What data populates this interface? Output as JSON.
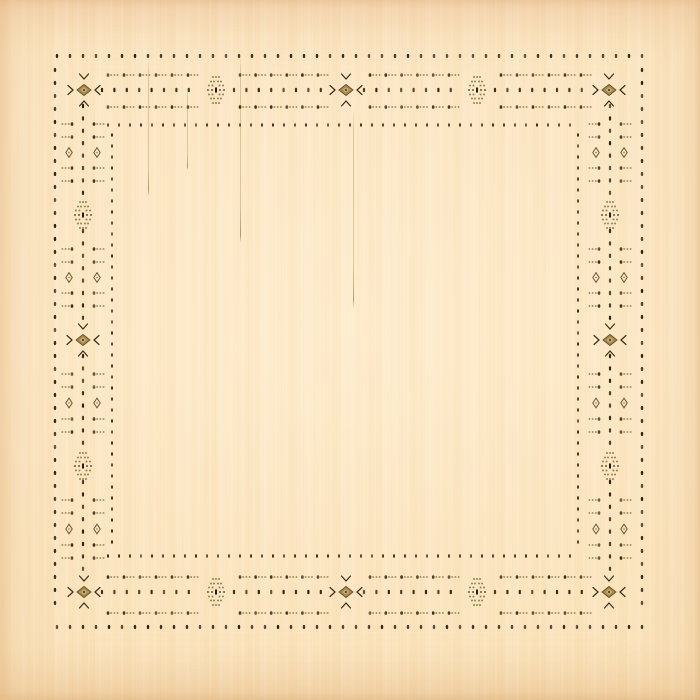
{
  "canvas": {
    "width": 700,
    "height": 700
  },
  "fabric": {
    "base_color": "#fce7c4",
    "highlight_color": "#fff0d6",
    "edge_color": "#f4d6a6",
    "threads": [
      {
        "x": 148,
        "y1": 58,
        "y2": 196
      },
      {
        "x": 187,
        "y1": 88,
        "y2": 170
      },
      {
        "x": 240,
        "y1": 52,
        "y2": 243
      },
      {
        "x": 353,
        "y1": 108,
        "y2": 308
      }
    ]
  },
  "pattern": {
    "colors": {
      "dot": "#2b2110",
      "dot_inner": "#3a2d1a",
      "arrow_head": "#3a2d16",
      "arrow_tail": "#8f7b49",
      "chevron": "#392c17",
      "diamond_fill": "#a8894e",
      "diamond_edge": "#65512a",
      "diamond_core": "#c9ad72",
      "diamond_center": "#4a3a1c",
      "cluster_dot": "#84703e",
      "cluster_dark": "#4f4122",
      "cluster_dash": "#241c0e",
      "outline_diamond": "#6b5a30"
    },
    "sides": {
      "top": {
        "outer": 56,
        "arrowA": 75,
        "center": 90,
        "arrowB": 107,
        "inner": 125
      },
      "bottom": {
        "outer": 627,
        "arrowA": 613,
        "center": 592,
        "arrowB": 577,
        "inner": 556
      },
      "left": {
        "outer": 55,
        "arrowA": 69,
        "center": 83,
        "arrowB": 97,
        "inner": 112
      },
      "right": {
        "outer": 642,
        "arrowA": 623,
        "center": 610,
        "arrowB": 597,
        "inner": 578
      }
    },
    "big_motifs_h": {
      "xs": [
        84,
        216,
        346,
        477,
        609
      ],
      "types": [
        "diamond",
        "cluster",
        "diamond",
        "cluster",
        "diamond"
      ]
    },
    "big_motifs_v": {
      "ys": [
        90,
        215,
        340,
        466,
        592
      ],
      "types": [
        "diamond",
        "cluster",
        "diamond",
        "cluster",
        "diamond"
      ]
    },
    "outer_ring": {
      "step": 13,
      "h_from": 57,
      "h_to": 643,
      "v_from": 70,
      "v_to": 614
    },
    "inner_ring": {
      "step": 11,
      "h_from": 108,
      "h_to": 580,
      "v_from": 135,
      "v_to": 547
    },
    "center_dot_step": 12.4,
    "arrows_per_segment": 6,
    "cluster_rows": [
      {
        "dy": -13,
        "xs": [
          -3,
          0,
          3
        ]
      },
      {
        "dy": -8.5,
        "xs": [
          -5,
          -2,
          2,
          5
        ]
      },
      {
        "dy": -4.5,
        "xs": [
          -7,
          -3.5,
          3.5,
          7
        ]
      },
      {
        "dy": 0,
        "xs": [
          -8,
          -4,
          4,
          8
        ]
      },
      {
        "dy": 4.5,
        "xs": [
          -7,
          -3.5,
          3.5,
          7
        ]
      },
      {
        "dy": 8.5,
        "xs": [
          -5,
          -2,
          2,
          5
        ]
      },
      {
        "dy": 13,
        "xs": [
          -3,
          0,
          3
        ]
      }
    ]
  }
}
